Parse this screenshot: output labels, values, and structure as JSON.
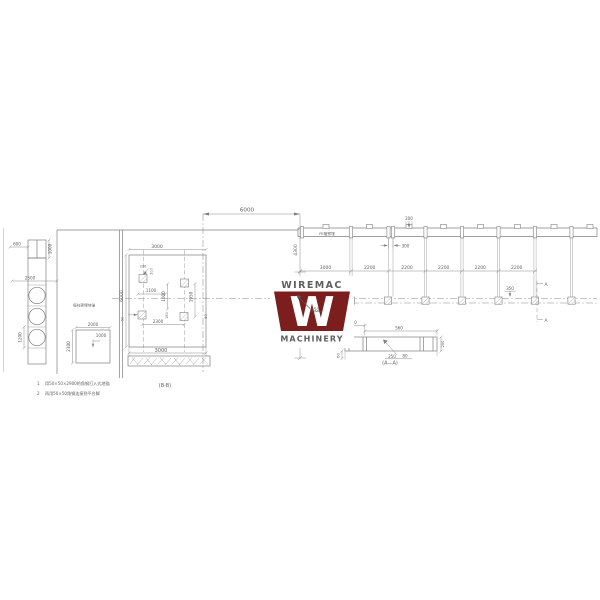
{
  "logo": {
    "line1": "WIREMAC",
    "letter": "W",
    "line2": "MACHINERY",
    "color": "#7C1E1E"
  },
  "labels": {
    "pe_pipe": "PE管预埋",
    "section_a": "A",
    "section_aa": "(A—A)",
    "section_bb": "(B-B)",
    "channel": "#50",
    "anchor_note": "每柱预埋地锚"
  },
  "notes": [
    {
      "num": "1",
      "text": "用50×50×2900的角钢打入式地锚"
    },
    {
      "num": "2",
      "text": "再用50×50角钢连接到平台脚"
    }
  ],
  "dims": {
    "top_span": "6000",
    "height_upper": "4300",
    "height_lower": "4700",
    "rail_spacing": [
      "3000",
      "2200",
      "2200",
      "2200",
      "2200",
      "2200"
    ],
    "post_cap": "200",
    "post_gap": "300",
    "rail_offset": "350",
    "aa": {
      "left": "150",
      "span": "560",
      "height": "60",
      "bottom1": "250",
      "bottom2": "80",
      "right": "200"
    },
    "bb": {
      "top": "3000",
      "bottom": "3000",
      "left": "6000",
      "pad_a": "200",
      "pad_b": "200",
      "pad_x": "1100",
      "pad_y": "1000",
      "pad_y2": "1950",
      "pad_small": "180",
      "pad_span": "2300",
      "edge_left": "50",
      "edge_right": "50"
    },
    "left": {
      "top_w": "600",
      "top_h": "1000",
      "width": "2500",
      "cell": "1200",
      "sq_w": "2000",
      "sq_h": "2100",
      "sq_inner": "1000"
    }
  }
}
